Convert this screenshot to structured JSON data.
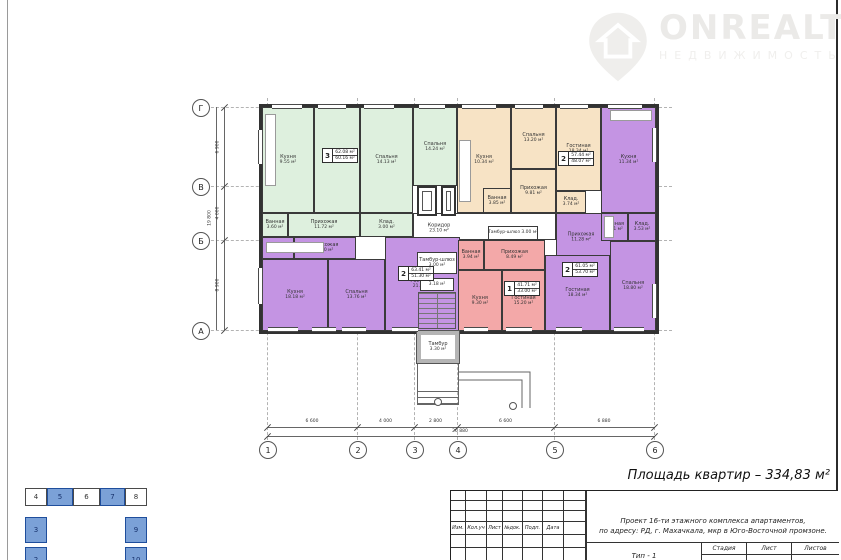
{
  "watermark": {
    "brand": "ONREALT",
    "subtitle": "НЕДВИЖИМОСТЬ"
  },
  "summary": {
    "total_area": "Площадь квартир – 334,83 м²"
  },
  "colors": {
    "green": "#def0de",
    "orange": "#f7e3c5",
    "purple": "#c494e3",
    "pink": "#f3a8a8",
    "white": "#ffffff",
    "keyplan_blue": "#7ba1d7",
    "wall": "#3a3a3a"
  },
  "axes": {
    "horizontal": [
      "1",
      "2",
      "3",
      "4",
      "5",
      "6"
    ],
    "vertical": [
      "Г",
      "В",
      "Б",
      "А"
    ]
  },
  "dimensions": {
    "bottom": [
      "6 600",
      "4 000",
      "2 800",
      "6 600",
      "6 880"
    ],
    "bottom_total": "26 880",
    "left": [
      "6 900",
      "4 000",
      "8 900"
    ],
    "left_total": "19 800"
  },
  "rooms": {
    "g_kitchen": {
      "name": "Кухня",
      "area": "9.55 м²"
    },
    "g_living": {
      "name": "Гостиная",
      "area": "18.53 м²"
    },
    "g_bed1": {
      "name": "Спальня",
      "area": "14.13 м²"
    },
    "g_bed2": {
      "name": "Спальня",
      "area": "14.24 м²"
    },
    "g_bath": {
      "name": "Ванная",
      "area": "3.60 м²"
    },
    "g_hall": {
      "name": "Прихожая",
      "area": "11.72 м²"
    },
    "g_stor": {
      "name": "Клад.",
      "area": "3.00 м²"
    },
    "o_kitchen": {
      "name": "Кухня",
      "area": "10.34 м²"
    },
    "o_bed": {
      "name": "Спальня",
      "area": "13.20 м²"
    },
    "o_living": {
      "name": "Гостиная",
      "area": "18.34 м²"
    },
    "o_hall": {
      "name": "Прихожая",
      "area": "9.81 м²"
    },
    "o_bath": {
      "name": "Ванная",
      "area": "3.85 м²"
    },
    "o_stor": {
      "name": "Клад.",
      "area": "3.74 м²"
    },
    "p1_kitchen": {
      "name": "Кухня",
      "area": "11.34 м²"
    },
    "p1_hall": {
      "name": "Прихожая",
      "area": "11.28 м²"
    },
    "p1_bath": {
      "name": "Ванная",
      "area": "3.51 м²"
    },
    "p1_stor": {
      "name": "Клад.",
      "area": "3.53 м²"
    },
    "p1_living": {
      "name": "Гостиная",
      "area": "18.34 м²"
    },
    "p1_bed": {
      "name": "Спальня",
      "area": "18.80 м²"
    },
    "p2_bath": {
      "name": "Ванная",
      "area": "3.68 м²"
    },
    "p2_hall": {
      "name": "Прихожая",
      "area": "8.20 м²"
    },
    "p2_kitchen": {
      "name": "Кухня",
      "area": "18.18 м²"
    },
    "p2_bed": {
      "name": "Спальня",
      "area": "13.76 м²"
    },
    "p2_living": {
      "name": "Гостиная",
      "area": "21.66 м²"
    },
    "pk_bath": {
      "name": "Ванная",
      "area": "3.94 м²"
    },
    "pk_hall": {
      "name": "Прихожая",
      "area": "8.49 м²"
    },
    "pk_kitchen": {
      "name": "Кухня",
      "area": "9.30 м²"
    },
    "pk_living": {
      "name": "Гостиная",
      "area": "15.20 м²"
    },
    "core_corr_a": {
      "name": "Коридор",
      "area": "23.10 м²"
    },
    "core_tambur1": {
      "name": "Тамбур-шлюз",
      "area": "3.00 м²"
    },
    "core_tambur2": {
      "name": "Тамбур-шлюз",
      "area": "3.00 м²"
    },
    "core_lobby": {
      "name": "",
      "area": "3.18 м²"
    },
    "entry_tambur": {
      "name": "Тамбур",
      "area": "3.30 м²"
    }
  },
  "stamps": {
    "green": {
      "num": "3",
      "total": "62.08 м²",
      "living": "60.16 м²"
    },
    "orange": {
      "num": "2",
      "total": "57.44 м²",
      "living": "48.07 м²"
    },
    "purple_left": {
      "num": "2",
      "total": "63.41 м²",
      "living": "51.30 м²"
    },
    "pink": {
      "num": "1",
      "total": "41.71 м²",
      "living": "33.00 м²"
    },
    "purple_right": {
      "num": "2",
      "total": "61.05 м²",
      "living": "53.70 м²"
    }
  },
  "title_block": {
    "cols": [
      "Изм.",
      "Кол.уч",
      "Лист",
      "№док.",
      "Подп.",
      "Дата"
    ],
    "project_line1": "Проект 16-ти этажного комплекса апартаментов,",
    "project_line2": "по адресу: РД, г. Махачкала, мкр в Юго-Восточной промзоне.",
    "sheet_title": "Тип - 1",
    "stage_label": "Стадия",
    "sheet_label": "Лист",
    "sheets_label": "Листов"
  },
  "key_plan": {
    "cells": [
      {
        "label": "4",
        "filled": false
      },
      {
        "label": "5",
        "filled": true
      },
      {
        "label": "6",
        "filled": false
      },
      {
        "label": "7",
        "filled": true
      },
      {
        "label": "8",
        "filled": false
      },
      {
        "label": "3",
        "filled": true
      },
      {
        "label": "2",
        "filled": true
      },
      {
        "label": "9",
        "filled": true
      },
      {
        "label": "10",
        "filled": true
      }
    ]
  }
}
